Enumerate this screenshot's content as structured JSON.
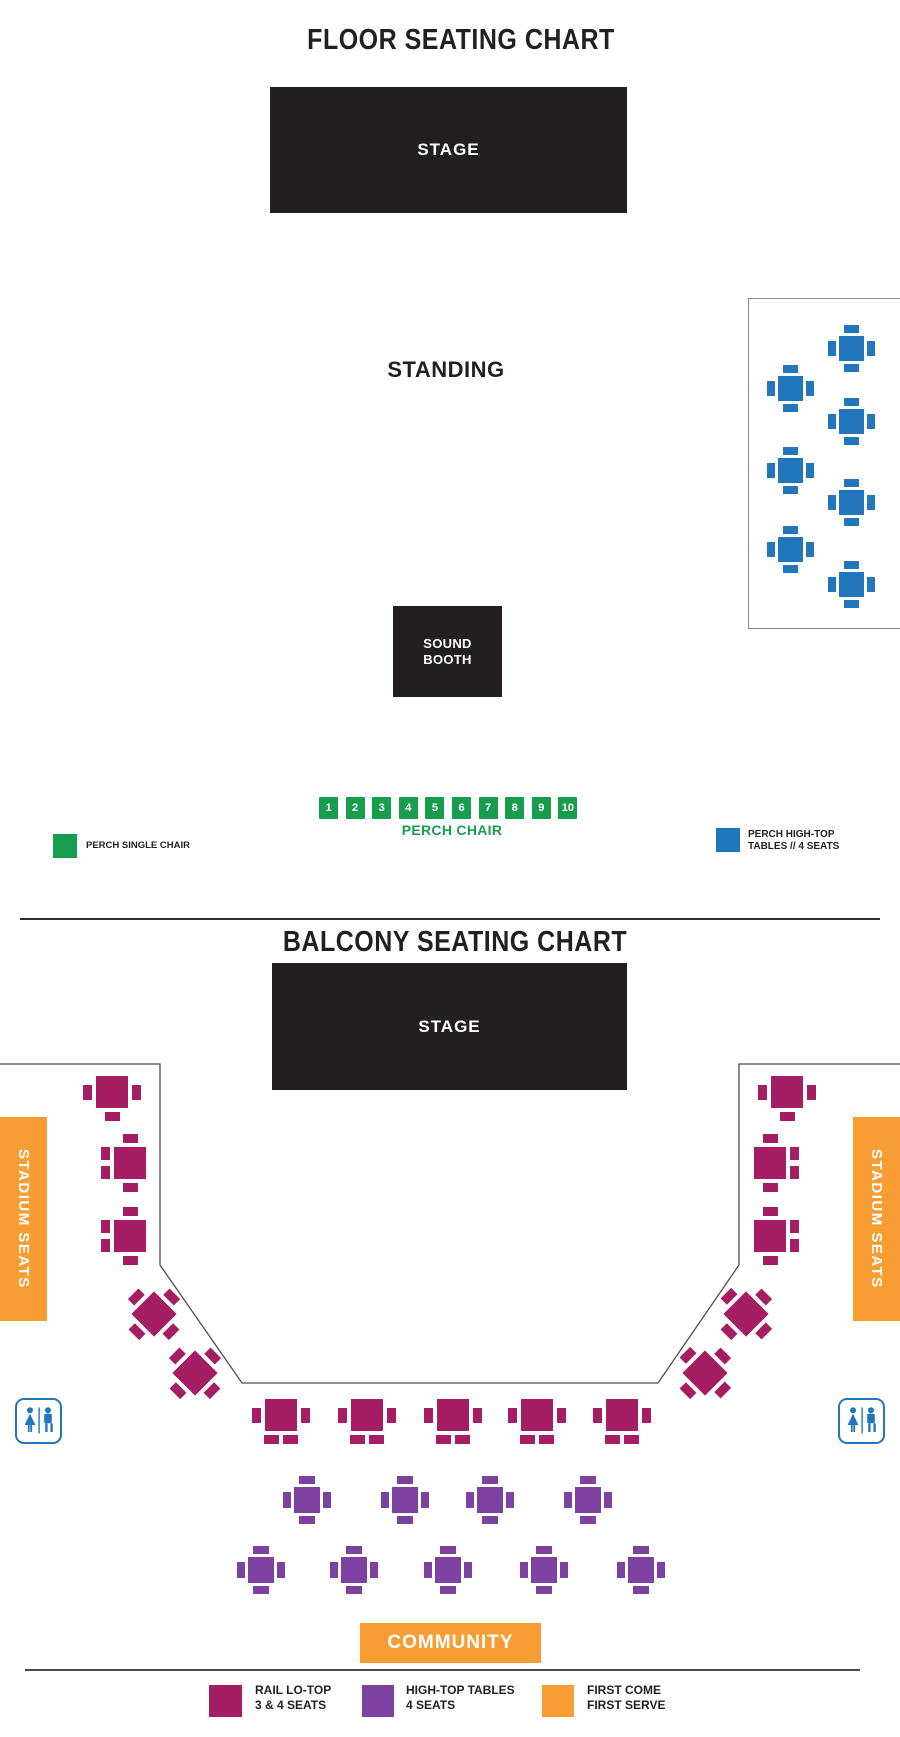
{
  "colors": {
    "stage": "#231f20",
    "magenta": "#a51e63",
    "purple": "#7d42a1",
    "orange": "#f79d33",
    "blue": "#2176bc",
    "green": "#189c4d",
    "outline": "#4d4d4d"
  },
  "floor": {
    "title": "FLOOR SEATING CHART",
    "stage_label": "STAGE",
    "standing_label": "STANDING",
    "sound_booth_line1": "SOUND",
    "sound_booth_line2": "BOOTH",
    "perch_chairs": [
      "1",
      "2",
      "3",
      "4",
      "5",
      "6",
      "7",
      "8",
      "9",
      "10"
    ],
    "perch_row_label": "PERCH CHAIR",
    "legend": {
      "single_chair_label": "PERCH SINGLE CHAIR",
      "high_top_line1": "PERCH HIGH-TOP",
      "high_top_line2": "TABLES // 4 SEATS"
    },
    "tables": [
      {
        "x": 851,
        "y": 348,
        "c": "blue",
        "t": "four"
      },
      {
        "x": 790,
        "y": 388,
        "c": "blue",
        "t": "four"
      },
      {
        "x": 851,
        "y": 421,
        "c": "blue",
        "t": "four"
      },
      {
        "x": 790,
        "y": 470,
        "c": "blue",
        "t": "four"
      },
      {
        "x": 851,
        "y": 502,
        "c": "blue",
        "t": "four"
      },
      {
        "x": 790,
        "y": 549,
        "c": "blue",
        "t": "four"
      },
      {
        "x": 851,
        "y": 584,
        "c": "blue",
        "t": "four"
      }
    ]
  },
  "balcony": {
    "title": "BALCONY SEATING CHART",
    "stage_label": "STAGE",
    "stadium_seats_left": "STADIUM SEATS",
    "stadium_seats_right": "STADIUM SEATS",
    "community_label": "COMMUNITY",
    "icons": {
      "restroom": "unisex-restroom"
    },
    "legend": [
      {
        "color": "magenta",
        "line1": "RAIL LO-TOP",
        "line2": "3 & 4 SEATS"
      },
      {
        "color": "purple",
        "line1": "HIGH-TOP TABLES",
        "line2": "4 SEATS"
      },
      {
        "color": "orange",
        "line1": "FIRST COME",
        "line2": "FIRST SERVE"
      }
    ],
    "tables": [
      {
        "x": 112,
        "y": 1092,
        "c": "magenta",
        "t": "h3"
      },
      {
        "x": 130,
        "y": 1163,
        "c": "magenta",
        "t": "v4l"
      },
      {
        "x": 130,
        "y": 1236,
        "c": "magenta",
        "t": "v4l"
      },
      {
        "x": 154,
        "y": 1314,
        "c": "magenta",
        "t": "d4",
        "r": 45
      },
      {
        "x": 195,
        "y": 1373,
        "c": "magenta",
        "t": "d4",
        "r": 45
      },
      {
        "x": 787,
        "y": 1092,
        "c": "magenta",
        "t": "h3"
      },
      {
        "x": 770,
        "y": 1163,
        "c": "magenta",
        "t": "v4r"
      },
      {
        "x": 770,
        "y": 1236,
        "c": "magenta",
        "t": "v4r"
      },
      {
        "x": 746,
        "y": 1314,
        "c": "magenta",
        "t": "d4",
        "r": -45
      },
      {
        "x": 705,
        "y": 1373,
        "c": "magenta",
        "t": "d4",
        "r": -45
      },
      {
        "x": 281,
        "y": 1415,
        "c": "magenta",
        "t": "b4"
      },
      {
        "x": 367,
        "y": 1415,
        "c": "magenta",
        "t": "b4"
      },
      {
        "x": 453,
        "y": 1415,
        "c": "magenta",
        "t": "b4"
      },
      {
        "x": 537,
        "y": 1415,
        "c": "magenta",
        "t": "b4"
      },
      {
        "x": 622,
        "y": 1415,
        "c": "magenta",
        "t": "b4"
      },
      {
        "x": 307,
        "y": 1500,
        "c": "purple",
        "t": "four"
      },
      {
        "x": 405,
        "y": 1500,
        "c": "purple",
        "t": "four"
      },
      {
        "x": 490,
        "y": 1500,
        "c": "purple",
        "t": "four"
      },
      {
        "x": 588,
        "y": 1500,
        "c": "purple",
        "t": "four"
      },
      {
        "x": 261,
        "y": 1570,
        "c": "purple",
        "t": "four"
      },
      {
        "x": 354,
        "y": 1570,
        "c": "purple",
        "t": "four"
      },
      {
        "x": 448,
        "y": 1570,
        "c": "purple",
        "t": "four"
      },
      {
        "x": 544,
        "y": 1570,
        "c": "purple",
        "t": "four"
      },
      {
        "x": 641,
        "y": 1570,
        "c": "purple",
        "t": "four"
      }
    ]
  }
}
